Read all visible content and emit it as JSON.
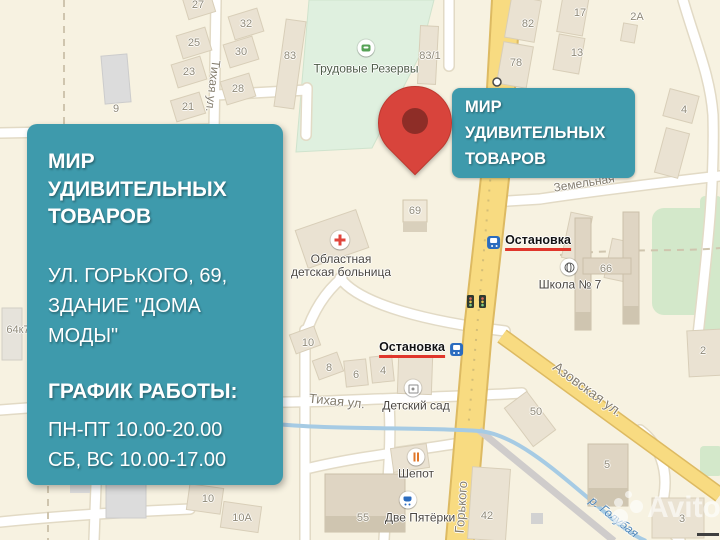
{
  "colors": {
    "overlay_teal": "#3E9AAC",
    "pin_red": "#D8443C",
    "pin_hole": "#8E2D27",
    "stop_underline_red": "#E0362B",
    "stop_icon_blue": "#2B6CBF",
    "road_yellow": "#F8DB81",
    "park_green": "#DFF0DF",
    "water_blue": "#A6CBE4",
    "land": "#F7F2E1"
  },
  "overlay": {
    "panel": {
      "title": "МИР УДИВИТЕЛЬНЫХ ТОВАРОВ",
      "address_line1": "УЛ. ГОРЬКОГО, 69,",
      "address_line2": "ЗДАНИЕ \"ДОМА МОДЫ\"",
      "schedule_heading": "ГРАФИК РАБОТЫ:",
      "schedule_line1": "ПН-ПТ 10.00-20.00",
      "schedule_line2": "СБ, ВС 10.00-17.00"
    },
    "callout": {
      "title": "МИР УДИВИТЕЛЬНЫХ ТОВАРОВ"
    },
    "watermark": "Avito"
  },
  "map": {
    "building_labels": [
      {
        "t": "27",
        "x": 198,
        "y": 5
      },
      {
        "t": "32",
        "x": 246,
        "y": 24
      },
      {
        "t": "25",
        "x": 194,
        "y": 43
      },
      {
        "t": "30",
        "x": 241,
        "y": 52
      },
      {
        "t": "23",
        "x": 189,
        "y": 72
      },
      {
        "t": "28",
        "x": 238,
        "y": 89
      },
      {
        "t": "21",
        "x": 188,
        "y": 107
      },
      {
        "t": "9",
        "x": 116,
        "y": 109
      },
      {
        "t": "83",
        "x": 290,
        "y": 56
      },
      {
        "t": "83/1",
        "x": 430,
        "y": 56
      },
      {
        "t": "82",
        "x": 528,
        "y": 24
      },
      {
        "t": "78",
        "x": 516,
        "y": 63
      },
      {
        "t": "17",
        "x": 580,
        "y": 13
      },
      {
        "t": "13",
        "x": 577,
        "y": 53
      },
      {
        "t": "2А",
        "x": 637,
        "y": 17
      },
      {
        "t": "4",
        "x": 684,
        "y": 110
      },
      {
        "t": "66",
        "x": 606,
        "y": 269
      },
      {
        "t": "69",
        "x": 415,
        "y": 211
      },
      {
        "t": "64к7",
        "x": 18,
        "y": 330
      },
      {
        "t": "10",
        "x": 308,
        "y": 343
      },
      {
        "t": "8",
        "x": 329,
        "y": 368
      },
      {
        "t": "6",
        "x": 356,
        "y": 375
      },
      {
        "t": "4",
        "x": 383,
        "y": 371
      },
      {
        "t": "10",
        "x": 208,
        "y": 499
      },
      {
        "t": "10А",
        "x": 242,
        "y": 518
      },
      {
        "t": "55",
        "x": 363,
        "y": 518
      },
      {
        "t": "50",
        "x": 536,
        "y": 412
      },
      {
        "t": "2",
        "x": 703,
        "y": 351
      },
      {
        "t": "5",
        "x": 607,
        "y": 465
      },
      {
        "t": "3",
        "x": 682,
        "y": 519
      },
      {
        "t": "42",
        "x": 487,
        "y": 516
      }
    ],
    "street_labels": [
      {
        "t": "Тихая ул.",
        "x": 213,
        "y": 86,
        "a": 97,
        "s": 12
      },
      {
        "t": "Тихая ул.",
        "x": 337,
        "y": 401,
        "a": 6,
        "s": 13
      },
      {
        "t": "Азовская ул.",
        "x": 588,
        "y": 389,
        "a": 36,
        "s": 14
      },
      {
        "t": "Земельная",
        "x": 584,
        "y": 183,
        "a": -9,
        "s": 12
      },
      {
        "t": "Горького",
        "x": 461,
        "y": 507,
        "a": -86,
        "s": 13
      }
    ],
    "river_labels": [
      {
        "t": "р. Голубая",
        "x": 614,
        "y": 517,
        "a": 38
      }
    ],
    "poi_icons": [
      {
        "icon": "park-icon",
        "name": "park-icon",
        "x": 366,
        "y": 48
      },
      {
        "icon": "hospital-icon",
        "name": "hospital-icon",
        "x": 340,
        "y": 240
      },
      {
        "icon": "school-icon",
        "name": "school-icon",
        "x": 569,
        "y": 267
      },
      {
        "icon": "kindergarten-icon",
        "name": "kindergarten-icon",
        "x": 413,
        "y": 388
      },
      {
        "icon": "food-icon",
        "name": "food-icon",
        "x": 416,
        "y": 457
      },
      {
        "icon": "cart-icon",
        "name": "cart-icon",
        "x": 408,
        "y": 500
      }
    ],
    "poi_labels": [
      {
        "t": "Трудовые Резервы",
        "x": 366,
        "y": 69,
        "c": "#4D5C48"
      },
      {
        "t": "Областная\nдетская больница",
        "x": 341,
        "y": 266
      },
      {
        "t": "Школа № 7",
        "x": 570,
        "y": 285
      },
      {
        "t": "Детский сад",
        "x": 416,
        "y": 406
      },
      {
        "t": "Шепот",
        "x": 416,
        "y": 474
      },
      {
        "t": "Две Пятёрки",
        "x": 420,
        "y": 518
      }
    ],
    "stops": [
      {
        "t": "Остановка",
        "x": 529,
        "y": 242,
        "side": "left",
        "name": "bus-stop-ostanovka-east"
      },
      {
        "t": "Остановка",
        "x": 421,
        "y": 349,
        "side": "right",
        "name": "bus-stop-ostanovka-west"
      }
    ]
  }
}
